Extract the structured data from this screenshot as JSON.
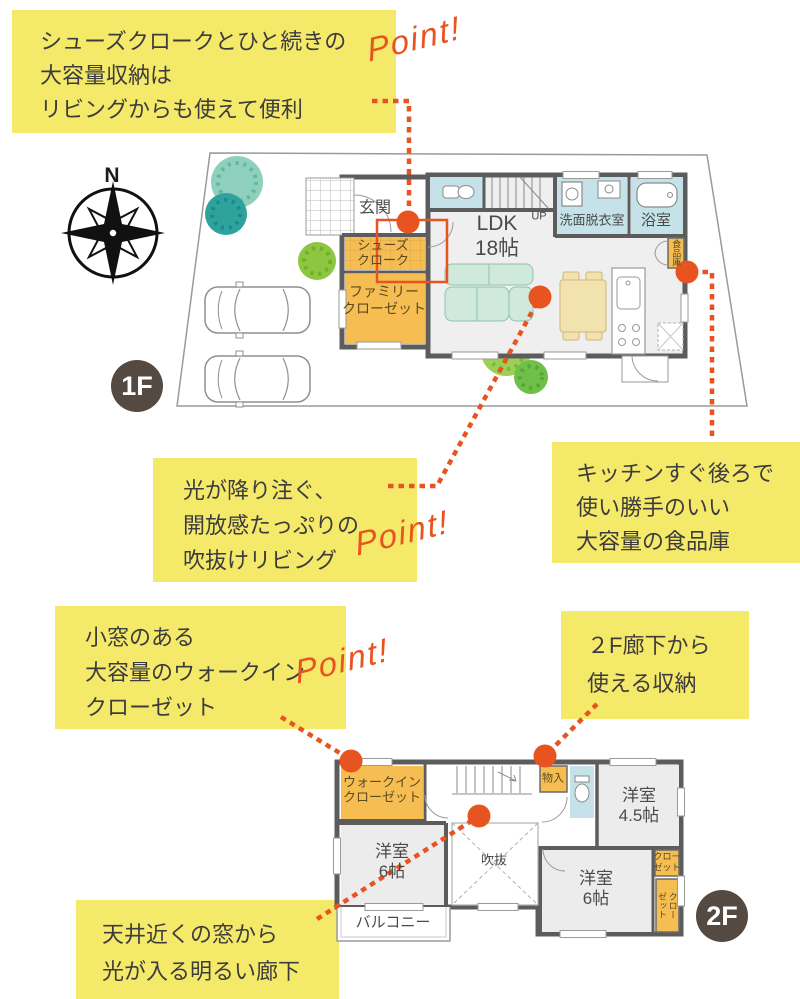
{
  "colors": {
    "accent_orange": "#e8541f",
    "note_yellow": "#f5e96a",
    "closet_orange": "#f6bd52",
    "water_blue": "#c4e2e7",
    "wall_gray": "#5c5c5c",
    "floor_gray": "#ededed",
    "badge_brown": "#554a42",
    "sofa_teal": "#cfe9dc",
    "table_tan": "#f2e2ad"
  },
  "point_label": "Point!",
  "compass": {
    "north": "N"
  },
  "badges": {
    "floor1": "1F",
    "floor2": "2F"
  },
  "notes": {
    "shoes": {
      "lines": [
        "シューズクロークとひと続きの",
        "大容量収納は",
        "リビングからも使えて便利"
      ]
    },
    "living": {
      "lines": [
        "光が降り注ぐ、",
        "開放感たっぷりの",
        "吹抜けリビング"
      ]
    },
    "pantry": {
      "lines": [
        "キッチンすぐ後ろで",
        "使い勝手のいい",
        "大容量の食品庫"
      ]
    },
    "wic": {
      "lines": [
        "小窓のある",
        "大容量のウォークイン",
        "クローゼット"
      ]
    },
    "storage2f": {
      "lines": [
        "２F廊下から",
        "使える収納"
      ]
    },
    "hallway": {
      "lines": [
        "天井近くの窓から",
        "光が入る明るい廊下"
      ]
    }
  },
  "floor1": {
    "genkan": "玄関",
    "shoes_cloak": {
      "l1": "シューズ",
      "l2": "クローク"
    },
    "family_closet": {
      "l1": "ファミリー",
      "l2": "クローゼット"
    },
    "ldk": {
      "l1": "LDK",
      "l2": "18帖"
    },
    "up": "UP",
    "washroom": "洗面脱衣室",
    "bath": "浴室",
    "pantry": "食品庫"
  },
  "floor2": {
    "wic": {
      "l1": "ウォークイン",
      "l2": "クローゼット"
    },
    "storage": "物入",
    "room45": {
      "l1": "洋室",
      "l2": "4.5帖"
    },
    "room6_left": {
      "l1": "洋室",
      "l2": "6帖"
    },
    "void": "吹抜",
    "room6_right": {
      "l1": "洋室",
      "l2": "6帖"
    },
    "closet_small": {
      "l1": "クロー",
      "l2": "ゼット"
    },
    "closet_tall": "クローゼット",
    "balcony": "バルコニー"
  }
}
